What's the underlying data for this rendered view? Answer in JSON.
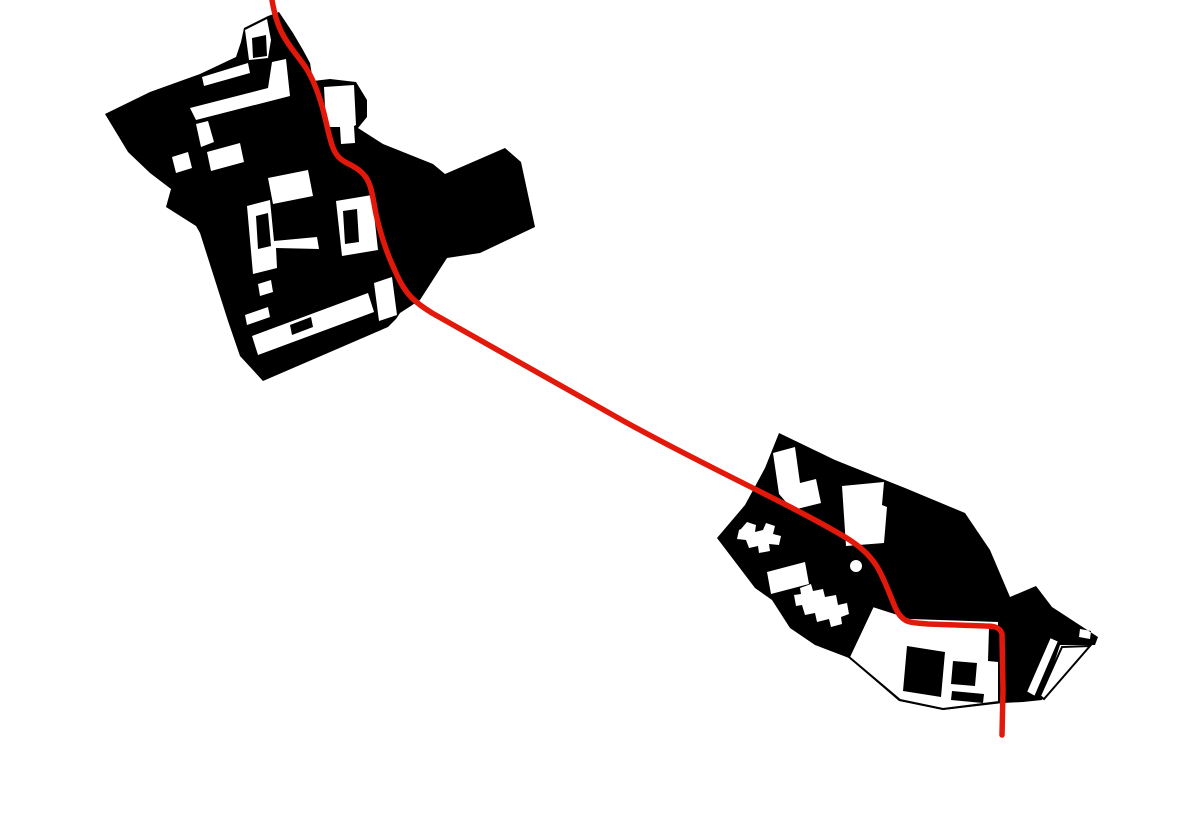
{
  "diagram": {
    "kind": "figure-ground-site-diagram",
    "description": "Black figure-ground plans of two settlement clusters (northwest and southeast) on a white background, connected by a single red route line that enters at the top edge, snakes through the northwest cluster, crosses open land diagonally, bends through the southeast cluster and exits near the bottom.",
    "canvas": {
      "width": 1200,
      "height": 833
    }
  },
  "palette": {
    "background": "#ffffff",
    "building": "#000000",
    "open_space": "#ffffff",
    "outline": "#000000",
    "route": "#e2190a"
  },
  "route": {
    "color": "#e2190a",
    "width": 5.5,
    "path": "M272 0C274 12 277 24 283 35C290 48 298 56 306 68C313 79 318 92 322 106C326 120 328 133 332 145C335 154 339 159 347 163C355 167 362 171 367 179C372 188 373 199 376 214C380 232 385 248 392 264C398 278 403 289 412 298C418 304 424 308 432 313C470 335 540 374 620 419C700 464 790 504 845 537C858 545 868 553 876 565C883 576 888 590 893 602C896 610 899 616 905 620C910 623 918 623 928 624L985 626C994 626 1000 627 1002 634L1003 690L1002 735"
  },
  "northwest_cluster": {
    "name": "northwest-settlement",
    "path": "M244 28L268 16L279 12L293 33L303 50L310 63L313 81L330 79L356 82L367 100L367 117L358 128L383 144L433 164L445 174L452 171L505 148L521 162L535 227L480 253L447 258L420 300L400 313L396 319L388 327L263 381L240 356L228 321L200 233L196 226L166 207L171 189L150 173L128 152L105 114L150 92L200 74L236 57L241 42Z M245 30L267 19L271 40L268 58L249 60Z M252 38L266 35L267 56L253 58Z M202 77L248 63L250 73L204 86Z M272 62L286 59L290 96L196 120L190 108L268 88Z M196 124L208 121L214 142L201 147Z M324 87L354 85L356 125L354 126L355 143L341 144L340 127L326 127Z M268 178L308 170L313 196L273 204Z M247 206L270 200L274 241L317 237L319 249L276 248L277 268L253 274Z M256 216L268 213L271 246L258 249Z M336 201L372 195L378 250L342 256Z M343 211L357 209L359 242L345 244Z M252 336L368 293L374 312L258 355Z M290 325L311 317L313 327L292 335Z M374 283L392 277L397 315L379 321Z M245 315L268 307L270 317L247 325Z M258 284L271 280L273 292L260 296Z M172 157L188 152L192 168L176 173Z M207 152L240 143L244 162L211 171Z"
  },
  "southeast_cluster": {
    "name": "southeast-settlement",
    "path": "M779 433L835 460L905 488L965 513L990 550L1010 597L1036 586L1052 607L1098 637L1095 645L1060 645L1042 700L1023 702L1003 703L943 710L899 701L849 658L815 645L790 628L772 600L755 588L717 538L745 505L765 468Z M773 453L795 447L800 483L816 479L821 503L793 510L779 494Z M741 529L747 522L756 525L755 532L763 530L766 523L775 526L773 534L781 536L779 545L769 544L770 551L759 553L758 546L749 548L746 540L737 539L739 530Z M842 486L884 482L882 505L887 507L884 543L846 546Z M850 566a6 6 0 1 0 12 0a6 6 0 1 0 -12 0Z M767 572L805 562L809 584L771 594Z M800 588L811 584L813 591L823 589L825 597L836 595L838 605L847 603L849 614L841 617L842 624L831 627L829 619L817 622L815 613L805 615L802 605L796 606L794 595L801 594Z M1080 629L1091 631L1090 639L1079 637Z",
    "street_outline": "M873 606L910 618L999 621L999 702L943 709L900 700L849 657Z",
    "street_islands": "M907 646L945 652L941 697L903 691ZM953 661L977 663L975 686L951 684ZM952 691L984 694L983 703L951 700ZM989 628L999 629L998 662L988 661Z",
    "tail_strip": "M1050 637L1059 641L1035 697L1026 692Z",
    "tail_triangle": "M1062 647L1090 646L1044 699L1040 696Z"
  }
}
